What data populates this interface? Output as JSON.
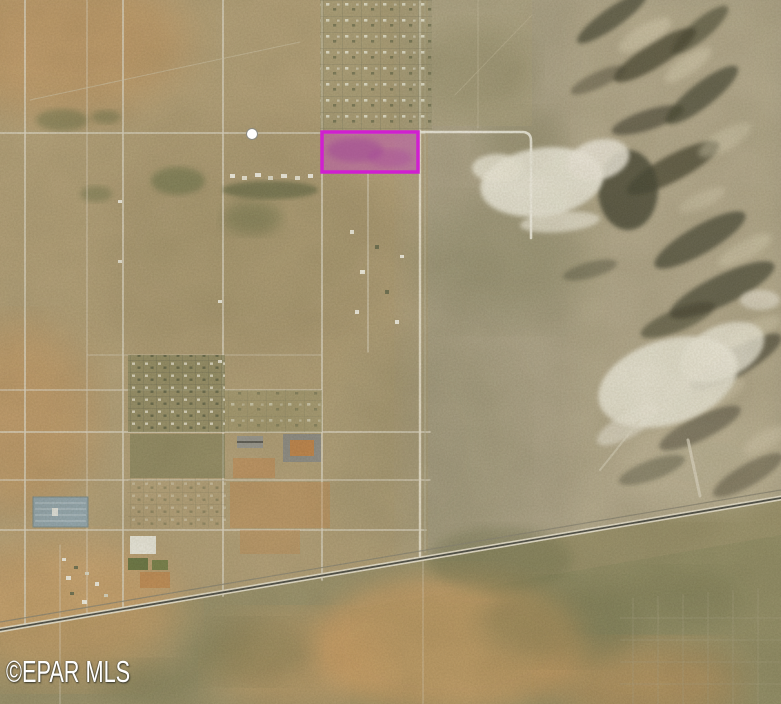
{
  "map": {
    "watermark": "©EPAR MLS",
    "highlighted_parcel": {
      "name": "highlighted-parcel",
      "outline_color": "#D01FD0",
      "fill_color": "#C93EC9",
      "fill_opacity": "0.38"
    },
    "poi_marker": {
      "name": "location-marker",
      "color": "#FFFFFF"
    },
    "palette": {
      "desert_tan": "#B3A077",
      "alluvial_gray": "#ADA387",
      "mountain_shadow": "#45432F",
      "quarry_white": "#ECE8DA",
      "scrub_olive": "#8F8C63",
      "dune_orange": "#D7A264",
      "facility_pond_blue": "#93A6AE",
      "road_light": "#DDD6C4",
      "highway_dark": "#4E4E44"
    }
  }
}
